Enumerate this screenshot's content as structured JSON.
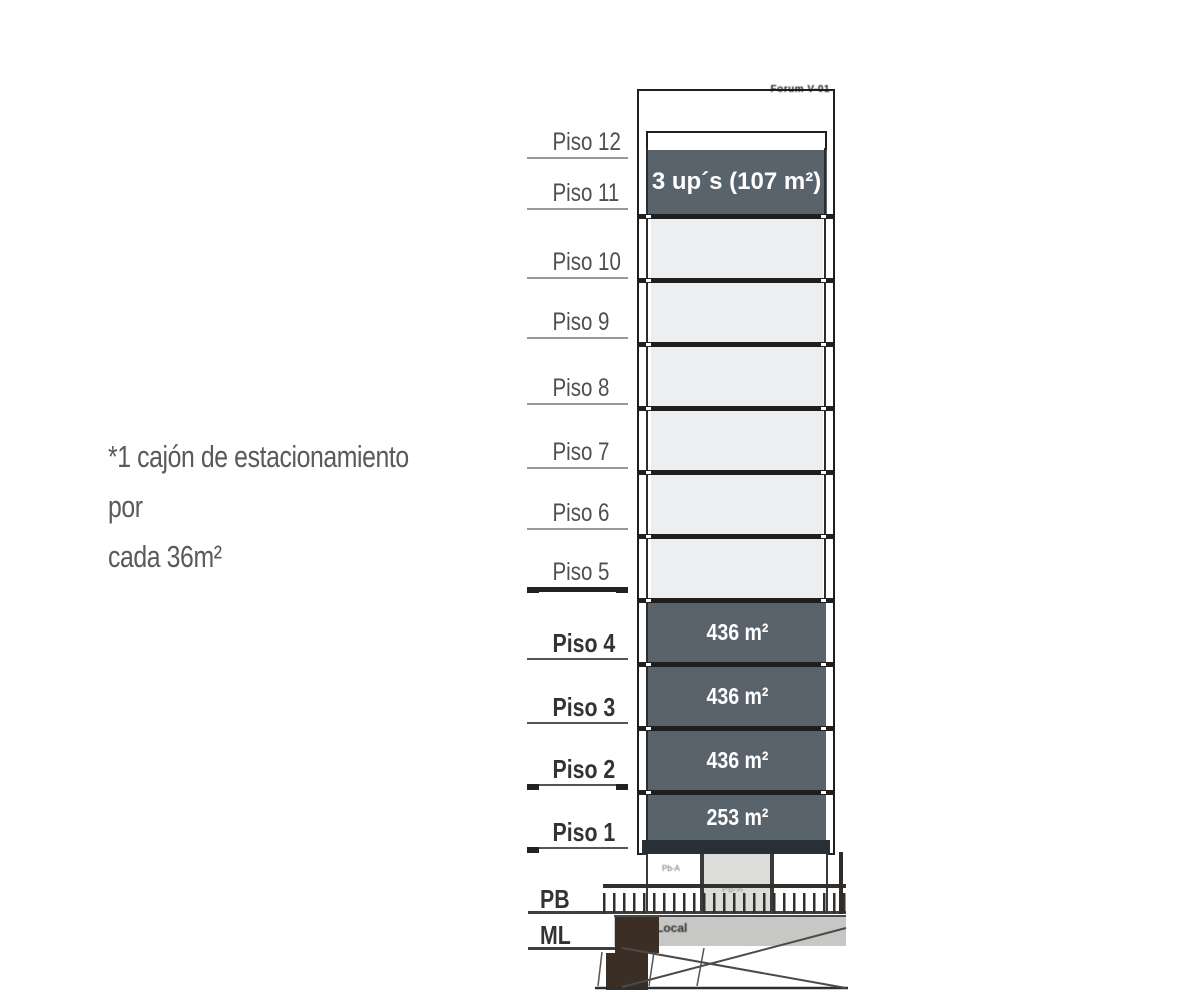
{
  "note": {
    "line1": "*1 cajón de estacionamiento por",
    "line2": "cada 36m²"
  },
  "levels": [
    {
      "label": "Piso 12"
    },
    {
      "label": "Piso 11"
    },
    {
      "label": "Piso 10"
    },
    {
      "label": "Piso 9"
    },
    {
      "label": "Piso 8"
    },
    {
      "label": "Piso 7"
    },
    {
      "label": "Piso 6"
    },
    {
      "label": "Piso 5"
    },
    {
      "label": "Piso 4"
    },
    {
      "label": "Piso 3"
    },
    {
      "label": "Piso 2"
    },
    {
      "label": "Piso 1"
    },
    {
      "label": "PB"
    },
    {
      "label": "ML"
    }
  ],
  "building": {
    "roof_label": "Forum V-01",
    "top_unit_label": "3 up´s (107 m²)",
    "floor_areas": [
      {
        "floor": "Piso 4",
        "area": "436 m²"
      },
      {
        "floor": "Piso 3",
        "area": "436 m²"
      },
      {
        "floor": "Piso 2",
        "area": "436 m²"
      },
      {
        "floor": "Piso 1",
        "area": "253 m²"
      }
    ]
  },
  "base": {
    "unit_left": "Pb-A",
    "unit_mid": "PB-A",
    "local_label": "Local"
  },
  "colors": {
    "dark_floor": "#59636c",
    "light_floor": "#eceef0",
    "slab": "#1e1e1e",
    "note_text": "#5a5a5a",
    "ml_band": "#c7c7c5",
    "core_brown": "#3a2e25"
  }
}
